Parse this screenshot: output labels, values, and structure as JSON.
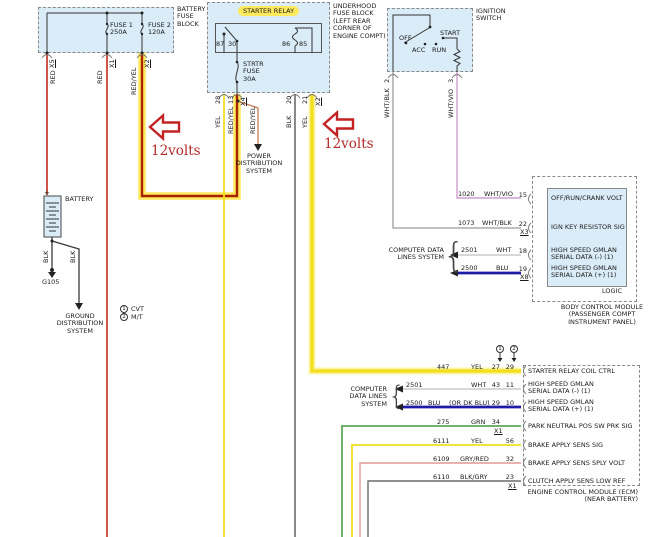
{
  "colors": {
    "box-fill": "#d9ecf8",
    "box-border": "#8a8a8a",
    "wire-red": "#c22a1d",
    "wire-redyel-core": "#a82400",
    "wire-redyel-branch": "#c9855c",
    "highlight-yellow": "#ffe95c",
    "highlight-pale": "#fdf3a0",
    "wire-yel": "#f2de1d",
    "wire-blk": "#4a4a4a",
    "wire-whtblk": "#9a9a9a",
    "wire-whtvio": "#cf9fd0",
    "wire-wht": "#bfbfbf",
    "wire-blu": "#1c1ca8",
    "wire-grn": "#3f9b3f",
    "wire-gryred": "#dd9a94",
    "wire-blkgry": "#6a6a6a",
    "annotation-red": "#c32222"
  },
  "battery_fuse_block": {
    "title": "BATTERY\nFUSE\nBLOCK",
    "fuse1": "FUSE 1\n250A",
    "fuse2": "FUSE 2\n120A",
    "conn_left": "X5",
    "conn_mid": "X1",
    "conn_right": "X2",
    "wire_left": "RED",
    "wire_mid": "RED",
    "wire_right": "RED/YEL"
  },
  "underhood_fuse_block": {
    "title": "UNDERHOOD\nFUSE BLOCK\n(LEFT REAR\nCORNER OF\nENGINE COMPT)",
    "relay_label": "STARTER RELAY",
    "pin_87": "87",
    "pin_30": "30",
    "pin_86": "86",
    "pin_85": "85",
    "strtr_fuse": "STRTR\nFUSE\n30A",
    "term_28": "28",
    "term_13": "13",
    "conn_x4": "X4",
    "term_20": "20",
    "term_21": "21",
    "conn_x2": "X2",
    "wire_87": "YEL",
    "wire_30": "RED/YEL",
    "wire_branch": "RED/YEL",
    "wire_86": "BLK",
    "wire_85": "YEL",
    "power_dist": "POWER\nDISTRIBUTION\nSYSTEM"
  },
  "ignition_switch": {
    "title": "IGNITION\nSWITCH",
    "pos_off": "OFF",
    "pos_acc": "ACC",
    "pos_run": "RUN",
    "pos_start": "START",
    "term_2": "2",
    "term_3": "3",
    "wire_2": "WHT/BLK",
    "wire_3": "WHT/VIO"
  },
  "battery": {
    "label": "BATTERY",
    "plus": "+",
    "wire_g105": "BLK",
    "wire_gnd": "BLK",
    "ground_ref": "G105",
    "ground_dist": "GROUND\nDISTRIBUTION\nSYSTEM"
  },
  "legend": {
    "item1_num": "1",
    "item1_label": "CVT",
    "item2_num": "2",
    "item2_label": "M/T"
  },
  "annotations": {
    "volts1": "12volts",
    "volts2": "12volts"
  },
  "bcm": {
    "caption": "BODY CONTROL MODULE\n(PASSENGER COMPT\nINSTRUMENT PANEL)",
    "logic_label": "LOGIC",
    "data_lines_label": "COMPUTER DATA\nLINES SYSTEM",
    "brace": "{",
    "rows": [
      {
        "circuit": "1020",
        "color": "WHT/VIO",
        "pin": "15",
        "conn": "",
        "desc": "OFF/RUN/CRANK VOLT"
      },
      {
        "circuit": "1073",
        "color": "WHT/BLK",
        "pin": "22",
        "conn": "X3",
        "desc": "IGN KEY RESISTOR SIG"
      },
      {
        "circuit": "2501",
        "color": "WHT",
        "pin": "18",
        "conn": "",
        "desc": "HIGH SPEED GMLAN\nSERIAL DATA (-) (1)"
      },
      {
        "circuit": "2500",
        "color": "BLU",
        "pin": "19",
        "conn": "X8",
        "desc": "HIGH SPEED GMLAN\nSERIAL DATA (+) (1)"
      }
    ]
  },
  "ecm": {
    "caption": "ENGINE CONTROL MODULE (ECM)\n(NEAR BATTERY)",
    "data_lines_label": "COMPUTER\nDATA LINES\nSYSTEM",
    "brace": "{",
    "col1_mark": "1",
    "col2_mark": "2",
    "rows": [
      {
        "circuit": "447",
        "color": "YEL",
        "note": "",
        "pin1": "27",
        "pin2": "29",
        "conn": "",
        "desc": "STARTER RELAY COIL CTRL"
      },
      {
        "circuit": "2501",
        "color": "WHT",
        "note": "",
        "pin1": "43",
        "pin2": "11",
        "conn": "",
        "desc": "HIGH SPEED GMLAN\nSERIAL DATA (-) (1)"
      },
      {
        "circuit": "2500",
        "color": "BLU",
        "note": "(OR DK BLU)",
        "pin1": "29",
        "pin2": "10",
        "conn": "",
        "desc": "HIGH SPEED GMLAN\nSERIAL DATA (+) (1)"
      },
      {
        "circuit": "275",
        "color": "GRN",
        "note": "",
        "pin1": "34",
        "pin2": "",
        "conn": "X1",
        "desc": "PARK NEUTRAL POS SW PRK SIG"
      },
      {
        "circuit": "6111",
        "color": "YEL",
        "note": "",
        "pin1": "",
        "pin2": "56",
        "conn": "",
        "desc": "BRAKE APPLY SENS SIG"
      },
      {
        "circuit": "6109",
        "color": "GRY/RED",
        "note": "",
        "pin1": "",
        "pin2": "32",
        "conn": "",
        "desc": "BRAKE APPLY SENS SPLY VOLT"
      },
      {
        "circuit": "6110",
        "color": "BLK/GRY",
        "note": "",
        "pin1": "",
        "pin2": "23",
        "conn": "X1",
        "desc": "CLUTCH APPLY SENS LOW REF"
      }
    ]
  }
}
